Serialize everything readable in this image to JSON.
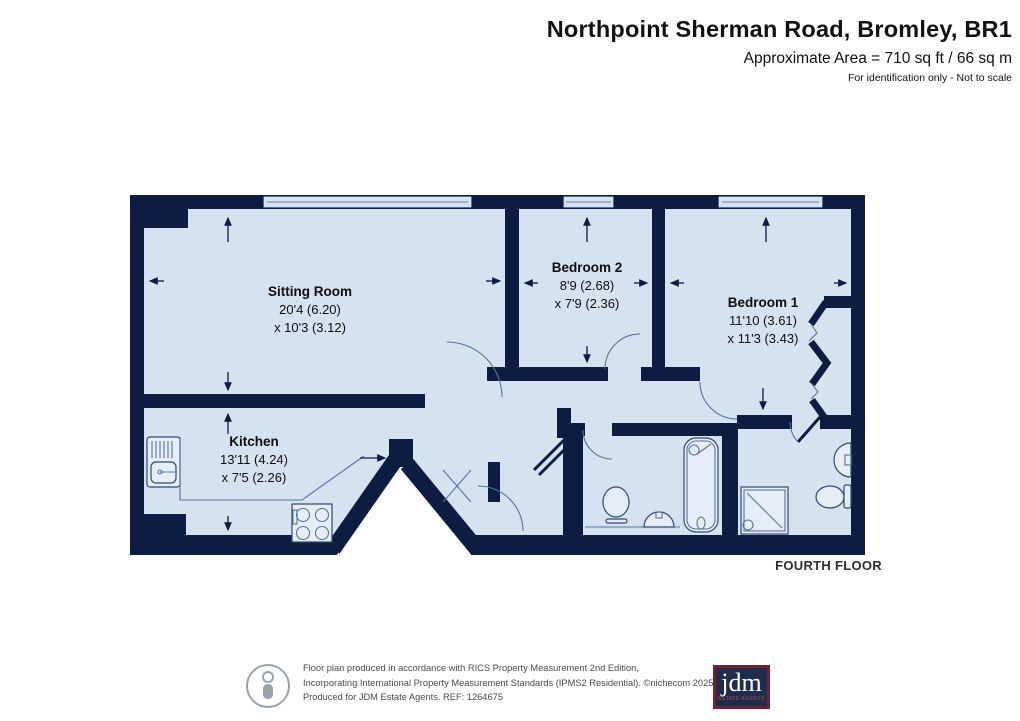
{
  "header": {
    "title": "Northpoint Sherman Road, Bromley, BR1",
    "area_line": "Approximate Area = 710 sq ft / 66 sq m",
    "disclaimer": "For identification only - Not to scale"
  },
  "plan": {
    "floor_label": "FOURTH FLOOR",
    "rooms": [
      {
        "name": "Sitting Room",
        "size_line1": "20'4 (6.20)",
        "size_line2": "x 10'3 (3.12)"
      },
      {
        "name": "Kitchen",
        "size_line1": "13'11 (4.24)",
        "size_line2": "x 7'5 (2.26)"
      },
      {
        "name": "Bedroom 2",
        "size_line1": "8'9 (2.68)",
        "size_line2": "x 7'9 (2.36)"
      },
      {
        "name": "Bedroom 1",
        "size_line1": "11'10 (3.61)",
        "size_line2": "x 11'3 (3.43)"
      }
    ],
    "fixtures": [
      "kitchen-sink",
      "hob",
      "toilet",
      "basin",
      "bathtub",
      "shower",
      "wardrobe"
    ]
  },
  "footer": {
    "line1": "Floor plan produced in accordance with RICS Property Measurement 2nd Edition,",
    "line2": "Incorporating International Property Measurement Standards (IPMS2 Residential).  ©nichecom 2025.",
    "line3": "Produced for JDM Estate Agents.   REF: 1264675",
    "ref": "1264675",
    "icon": "person-in-circle-icon",
    "logo": {
      "text": "jdm",
      "subtext": "ESTATE AGENTS"
    }
  },
  "colors": {
    "wall": "#0d1d42",
    "floor": "#d5e2f0",
    "line": "#56749c",
    "logo_navy": "#1e2d4f",
    "logo_border": "#73212e",
    "logo_red": "#b34552"
  }
}
